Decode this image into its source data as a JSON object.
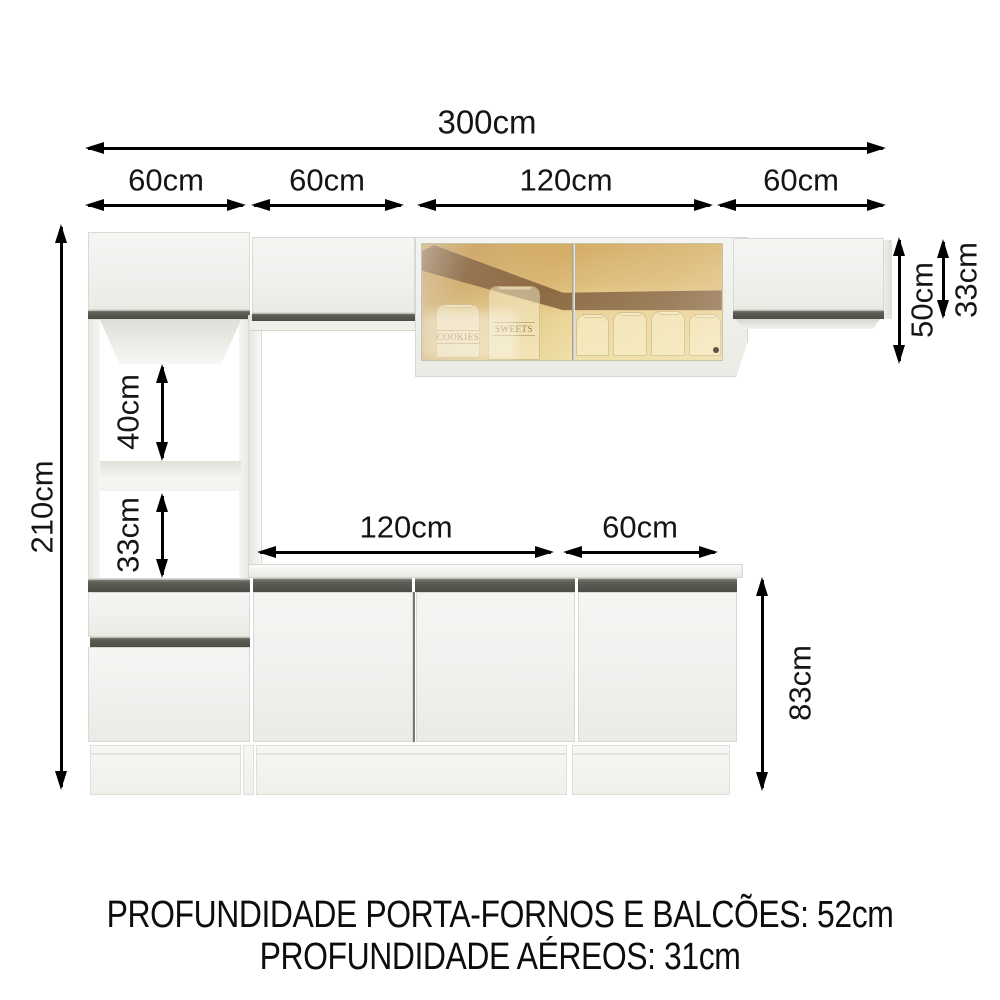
{
  "diagram": {
    "dims": {
      "total_width": "300cm",
      "top_seg_1": "60cm",
      "top_seg_2": "60cm",
      "top_seg_3": "120cm",
      "top_seg_4": "60cm",
      "total_height": "210cm",
      "glass_cabinet_height": "50cm",
      "aerial_cabinet_height": "33cm",
      "niche_upper_height": "40cm",
      "niche_lower_height": "33cm",
      "counter_seg_1": "120cm",
      "counter_seg_2": "60cm",
      "base_cabinet_height": "83cm"
    },
    "glass_cabinet": {
      "jar_label_1": "COOKIES",
      "jar_label_2": "SWEETS"
    },
    "footer": {
      "line1": "PROFUNDIDADE PORTA-FORNOS E BALCÕES: 52cm",
      "line2": "PROFUNDIDADE AÉREOS: 31cm"
    },
    "colors": {
      "handle_strip": "#565a52",
      "cabinet_white": "#f1f2ee",
      "glass_tint": "#ddba79",
      "ceiling_reflection": "#8f6c49",
      "dimension_text": "#151515"
    }
  }
}
